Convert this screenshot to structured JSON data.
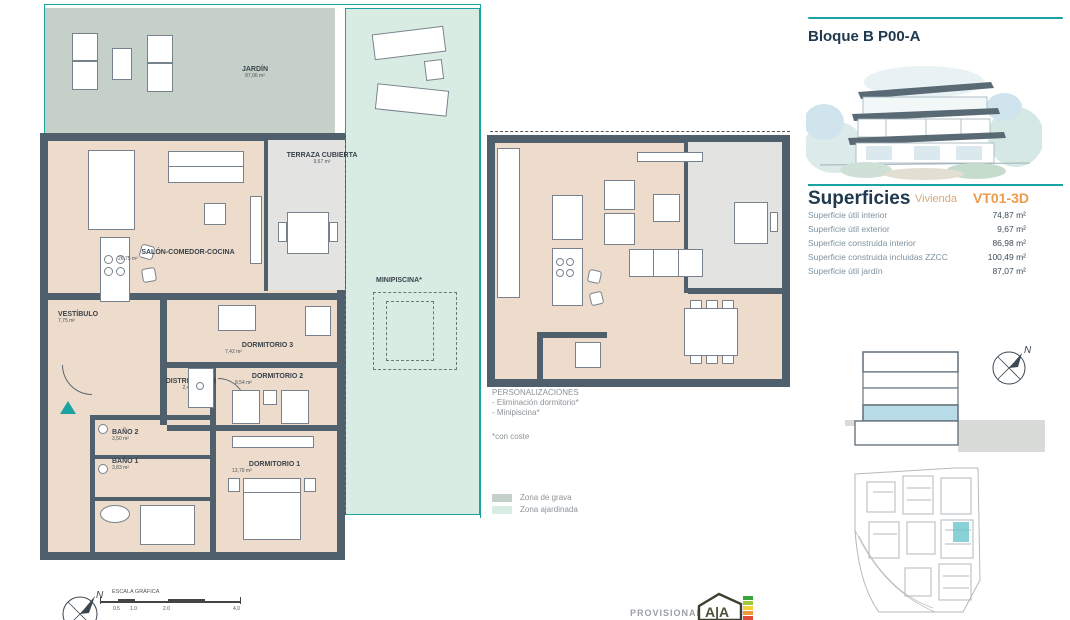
{
  "header": {
    "title": "Bloque B P00-A"
  },
  "superficies": {
    "heading": "Superficies",
    "subheading": "Vivienda",
    "unit_code": "VT01-3D",
    "rows": [
      {
        "label": "Superficie útil interior",
        "value": "74,87 m²"
      },
      {
        "label": "Superficie útil exterior",
        "value": "9,67 m²"
      },
      {
        "label": "Superficie construida interior",
        "value": "86,98 m²"
      },
      {
        "label": "Superficie construida incluidas ZZCC",
        "value": "100,49 m²"
      },
      {
        "label": "Superficie útil jardín",
        "value": "87,07 m²"
      }
    ]
  },
  "rooms": {
    "jardin": {
      "name": "JARDÍN",
      "area": "87,06 m²"
    },
    "terraza": {
      "name": "TERRAZA CUBIERTA",
      "area": "9,67 m²"
    },
    "salon": {
      "name": "SALÓN-COMEDOR-COCINA",
      "area": "26,75 m²"
    },
    "vestibulo": {
      "name": "VESTÍBULO",
      "area": "7,75 m²"
    },
    "distribuidor": {
      "name": "DISTRIBUIDOR",
      "area": "2,48 m²"
    },
    "dormitorio3": {
      "name": "DORMITORIO 3",
      "area": "7,42 m²"
    },
    "dormitorio2": {
      "name": "DORMITORIO 2",
      "area": "8,54 m²"
    },
    "dormitorio1": {
      "name": "DORMITORIO 1",
      "area": "13,79 m²"
    },
    "bano2": {
      "name": "BAÑO 2",
      "area": "3,50 m²"
    },
    "bano1": {
      "name": "BAÑO 1",
      "area": "3,83 m²"
    },
    "minipiscina": {
      "name": "MINIPISCINA*"
    }
  },
  "personalizaciones": {
    "title": "PERSONALIZACIONES",
    "items": [
      "- Eliminación dormitorio*",
      "- Minipiscina*"
    ],
    "footnote": "*con coste"
  },
  "legend": {
    "grava": {
      "label": "Zona de grava",
      "color": "#c5d1c8"
    },
    "ajardinada": {
      "label": "Zona ajardinada",
      "color": "#d9ece3"
    }
  },
  "scale_bar": {
    "title": "ESCALA GRÁFICA",
    "ticks": [
      "0.5",
      "1.0",
      "2.0",
      "4.0"
    ]
  },
  "compass": {
    "north": "N"
  },
  "footer": {
    "provisional": "PROVISIONAL",
    "cert_logo": "AIA"
  },
  "colors": {
    "accent_teal": "#1ba3a1",
    "wall": "#4f5f6b",
    "floor_beige": "#eddccb",
    "terrace_gray": "#e3e3e1",
    "heading_navy": "#21394e",
    "code_orange": "#ee9a4d",
    "subheading_tan": "#d9a87a",
    "section_highlight": "#b7dbe7",
    "siteplan_highlight": "#6cc5c9"
  }
}
